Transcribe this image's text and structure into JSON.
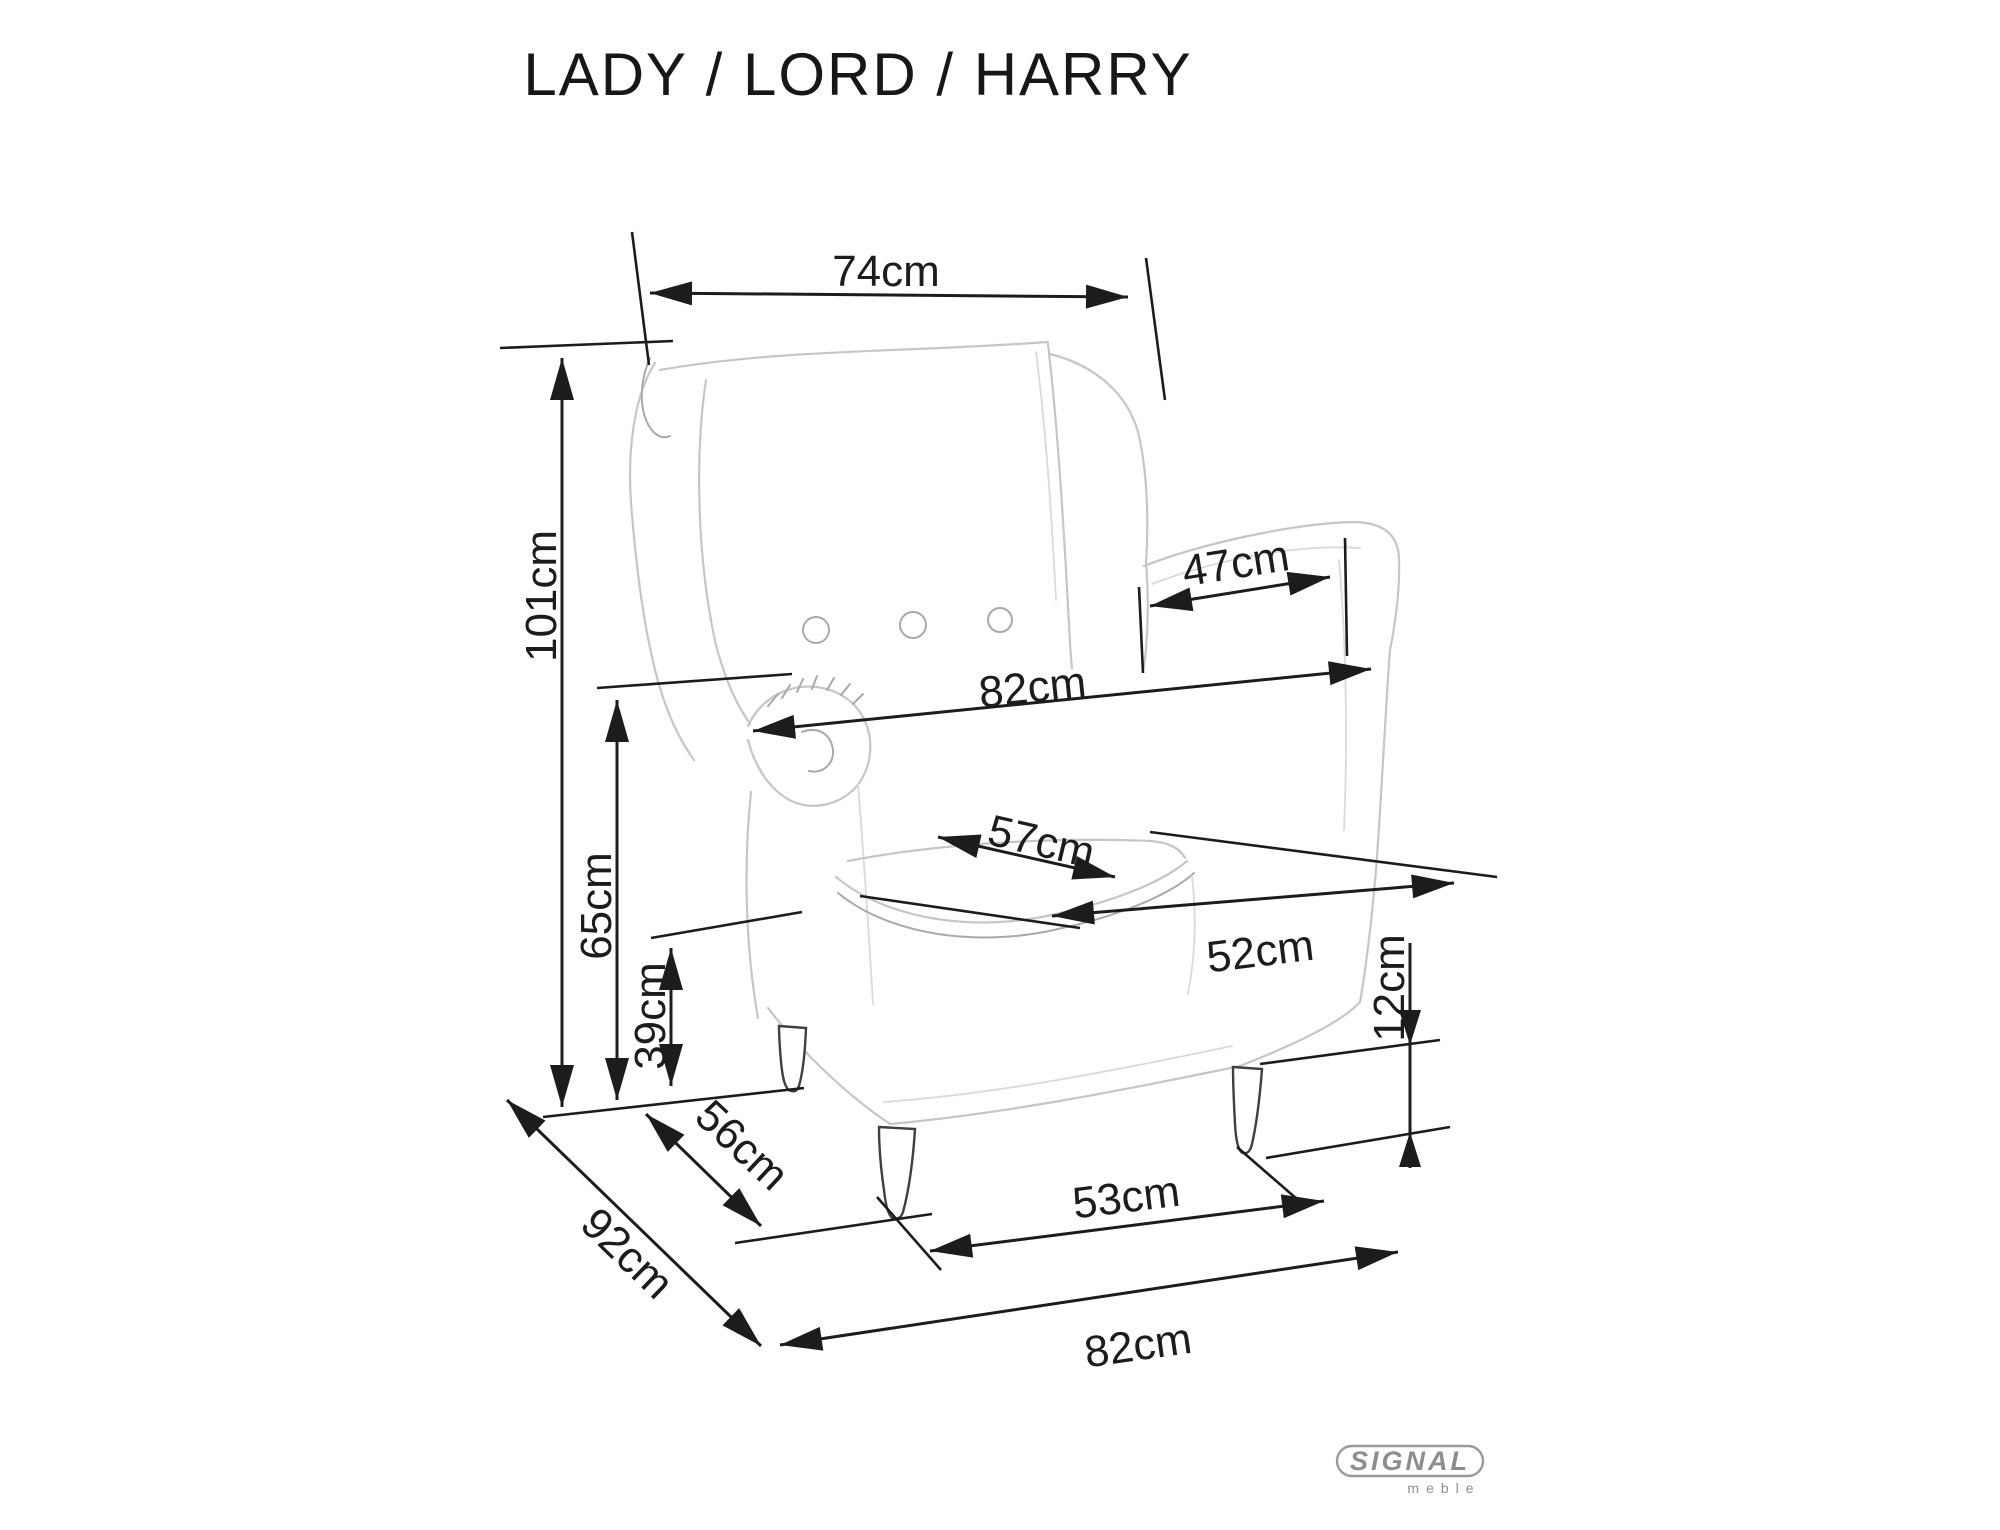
{
  "title": "LADY / LORD / HARRY",
  "dimensions": {
    "top_width": "74cm",
    "overall_height": "101cm",
    "armrest_height": "65cm",
    "seat_height": "39cm",
    "arm_depth": "47cm",
    "arm_span_width": "82cm",
    "seat_depth": "57cm",
    "seat_width": "52cm",
    "base_side_depth": "56cm",
    "overall_depth": "92cm",
    "front_leg_span": "53cm",
    "base_front_width": "82cm",
    "leg_height": "12cm"
  },
  "logo": {
    "brand": "SIGNAL",
    "sub": "meble"
  },
  "colors": {
    "dimension_lines": "#1c1c1c",
    "sketch_light": "#c6c6c6",
    "sketch_mid": "#a9a9a9",
    "legs": "#3f3f3f",
    "logo_gray": "#8d8d8d",
    "background": "#ffffff"
  }
}
